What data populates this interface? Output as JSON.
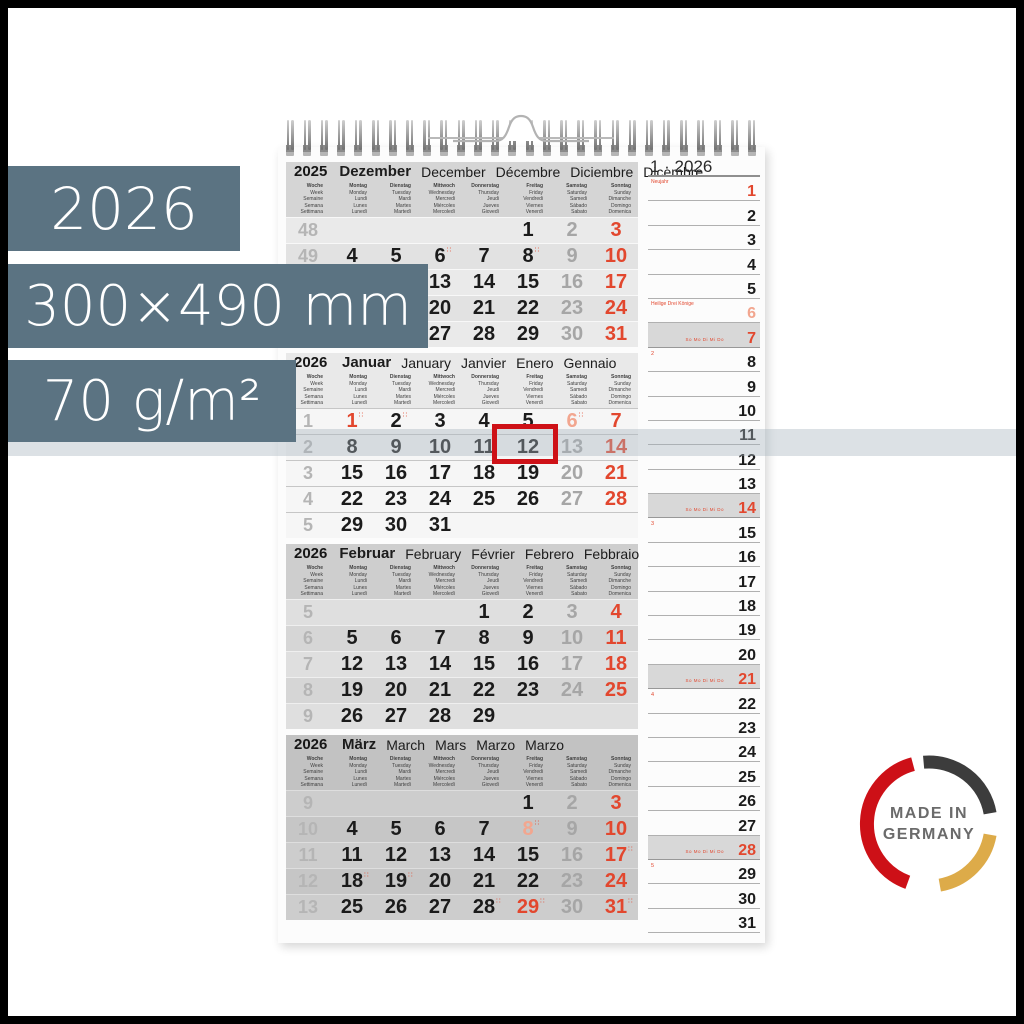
{
  "overlays": {
    "year": "2026",
    "size": "300×490 mm",
    "weight": "70 g/m²"
  },
  "colors": {
    "slate_overlay": "#5b7382",
    "accent_red": "#e2472e",
    "light_holiday": "#f2a68f",
    "saturday_gray": "#a6a6a6",
    "marker_red": "#ce1117",
    "badge_red": "#cd1017",
    "badge_dark": "#3c3c3c",
    "badge_gold": "#ddab49"
  },
  "badge": {
    "line1": "MADE IN",
    "line2": "GERMANY"
  },
  "marker": {
    "month": "Januar",
    "day": 12
  },
  "planner": {
    "header": "1 · 2026",
    "sunday_mini": "So Mo Di Mi Do",
    "days": [
      {
        "d": 1,
        "c": "r",
        "note": "Neujahr"
      },
      {
        "d": 2
      },
      {
        "d": 3
      },
      {
        "d": 4
      },
      {
        "d": 5
      },
      {
        "d": 6,
        "c": "s",
        "note": "Heilige Drei Könige"
      },
      {
        "d": 7,
        "c": "r",
        "sun": true
      },
      {
        "d": 8,
        "week": "2"
      },
      {
        "d": 9
      },
      {
        "d": 10
      },
      {
        "d": 11
      },
      {
        "d": 12
      },
      {
        "d": 13
      },
      {
        "d": 14,
        "c": "r",
        "sun": true
      },
      {
        "d": 15,
        "week": "3"
      },
      {
        "d": 16
      },
      {
        "d": 17
      },
      {
        "d": 18
      },
      {
        "d": 19
      },
      {
        "d": 20
      },
      {
        "d": 21,
        "c": "r",
        "sun": true
      },
      {
        "d": 22,
        "week": "4"
      },
      {
        "d": 23
      },
      {
        "d": 24
      },
      {
        "d": 25
      },
      {
        "d": 26
      },
      {
        "d": 27
      },
      {
        "d": 28,
        "c": "r",
        "sun": true
      },
      {
        "d": 29,
        "week": "5"
      },
      {
        "d": 30
      },
      {
        "d": 31
      }
    ]
  },
  "calendar": {
    "day_headers": [
      [
        "Woche",
        "Week",
        "Semaine",
        "Semana",
        "Settimana"
      ],
      [
        "Montag",
        "Monday",
        "Lundi",
        "Lunes",
        "Lunedì"
      ],
      [
        "Dienstag",
        "Tuesday",
        "Mardi",
        "Martes",
        "Martedì"
      ],
      [
        "Mittwoch",
        "Wednesday",
        "Mercredi",
        "Miércoles",
        "Mercoledì"
      ],
      [
        "Donnerstag",
        "Thursday",
        "Jeudi",
        "Jueves",
        "Giovedì"
      ],
      [
        "Freitag",
        "Friday",
        "Vendredi",
        "Viernes",
        "Venerdì"
      ],
      [
        "Samstag",
        "Saturday",
        "Samedi",
        "Sábado",
        "Sabato"
      ],
      [
        "Sonntag",
        "Sunday",
        "Dimanche",
        "Domingo",
        "Domenica"
      ]
    ],
    "months": [
      {
        "year": "2025",
        "theme": "dec",
        "names": [
          "Dezember",
          "December",
          "Décembre",
          "Diciembre",
          "Dicembre"
        ],
        "weeks": [
          {
            "w": "48",
            "days": [
              null,
              null,
              null,
              null,
              {
                "d": 1
              },
              {
                "d": 2,
                "c": "g"
              },
              {
                "d": 3,
                "c": "r"
              }
            ]
          },
          {
            "w": "49",
            "days": [
              {
                "d": 4
              },
              {
                "d": 5
              },
              {
                "d": 6,
                "m": true
              },
              {
                "d": 7
              },
              {
                "d": 8,
                "m": true
              },
              {
                "d": 9,
                "c": "g"
              },
              {
                "d": 10,
                "c": "r"
              }
            ]
          },
          {
            "w": "50",
            "days": [
              {
                "d": 11
              },
              {
                "d": 12
              },
              {
                "d": 13
              },
              {
                "d": 14
              },
              {
                "d": 15
              },
              {
                "d": 16,
                "c": "g"
              },
              {
                "d": 17,
                "c": "r"
              }
            ]
          },
          {
            "w": "51",
            "days": [
              {
                "d": 18
              },
              {
                "d": 19
              },
              {
                "d": 20
              },
              {
                "d": 21
              },
              {
                "d": 22
              },
              {
                "d": 23,
                "c": "g"
              },
              {
                "d": 24,
                "c": "r"
              }
            ]
          },
          {
            "w": "52",
            "days": [
              {
                "d": 25
              },
              {
                "d": 26
              },
              {
                "d": 27
              },
              {
                "d": 28
              },
              {
                "d": 29
              },
              {
                "d": 30,
                "c": "g"
              },
              {
                "d": 31,
                "c": "r"
              }
            ]
          }
        ]
      },
      {
        "year": "2026",
        "theme": "jan",
        "names": [
          "Januar",
          "January",
          "Janvier",
          "Enero",
          "Gennaio"
        ],
        "weeks": [
          {
            "w": "1",
            "days": [
              {
                "d": 1,
                "c": "r",
                "m": true
              },
              {
                "d": 2,
                "m": true
              },
              {
                "d": 3
              },
              {
                "d": 4
              },
              {
                "d": 5
              },
              {
                "d": 6,
                "c": "s",
                "m": true
              },
              {
                "d": 7,
                "c": "r"
              }
            ]
          },
          {
            "w": "2",
            "days": [
              {
                "d": 8
              },
              {
                "d": 9
              },
              {
                "d": 10
              },
              {
                "d": 11
              },
              {
                "d": 12
              },
              {
                "d": 13,
                "c": "g"
              },
              {
                "d": 14,
                "c": "r"
              }
            ]
          },
          {
            "w": "3",
            "days": [
              {
                "d": 15
              },
              {
                "d": 16
              },
              {
                "d": 17
              },
              {
                "d": 18
              },
              {
                "d": 19
              },
              {
                "d": 20,
                "c": "g"
              },
              {
                "d": 21,
                "c": "r"
              }
            ]
          },
          {
            "w": "4",
            "days": [
              {
                "d": 22
              },
              {
                "d": 23
              },
              {
                "d": 24
              },
              {
                "d": 25
              },
              {
                "d": 26
              },
              {
                "d": 27,
                "c": "g"
              },
              {
                "d": 28,
                "c": "r"
              }
            ]
          },
          {
            "w": "5",
            "days": [
              {
                "d": 29
              },
              {
                "d": 30
              },
              {
                "d": 31
              },
              null,
              null,
              null,
              null
            ]
          }
        ]
      },
      {
        "year": "2026",
        "theme": "feb",
        "names": [
          "Februar",
          "February",
          "Février",
          "Febrero",
          "Febbraio"
        ],
        "weeks": [
          {
            "w": "5",
            "days": [
              null,
              null,
              null,
              {
                "d": 1
              },
              {
                "d": 2
              },
              {
                "d": 3,
                "c": "g"
              },
              {
                "d": 4,
                "c": "r"
              }
            ]
          },
          {
            "w": "6",
            "days": [
              {
                "d": 5
              },
              {
                "d": 6
              },
              {
                "d": 7
              },
              {
                "d": 8
              },
              {
                "d": 9
              },
              {
                "d": 10,
                "c": "g"
              },
              {
                "d": 11,
                "c": "r"
              }
            ]
          },
          {
            "w": "7",
            "days": [
              {
                "d": 12
              },
              {
                "d": 13
              },
              {
                "d": 14
              },
              {
                "d": 15
              },
              {
                "d": 16
              },
              {
                "d": 17,
                "c": "g"
              },
              {
                "d": 18,
                "c": "r"
              }
            ]
          },
          {
            "w": "8",
            "days": [
              {
                "d": 19
              },
              {
                "d": 20
              },
              {
                "d": 21
              },
              {
                "d": 22
              },
              {
                "d": 23
              },
              {
                "d": 24,
                "c": "g"
              },
              {
                "d": 25,
                "c": "r"
              }
            ]
          },
          {
            "w": "9",
            "days": [
              {
                "d": 26
              },
              {
                "d": 27
              },
              {
                "d": 28
              },
              {
                "d": 29
              },
              null,
              null,
              null
            ]
          }
        ]
      },
      {
        "year": "2026",
        "theme": "mar",
        "names": [
          "März",
          "March",
          "Mars",
          "Marzo",
          "Marzo"
        ],
        "weeks": [
          {
            "w": "9",
            "days": [
              null,
              null,
              null,
              null,
              {
                "d": 1
              },
              {
                "d": 2,
                "c": "g"
              },
              {
                "d": 3,
                "c": "r"
              }
            ]
          },
          {
            "w": "10",
            "days": [
              {
                "d": 4
              },
              {
                "d": 5
              },
              {
                "d": 6
              },
              {
                "d": 7
              },
              {
                "d": 8,
                "c": "s",
                "m": true
              },
              {
                "d": 9,
                "c": "g"
              },
              {
                "d": 10,
                "c": "r"
              }
            ]
          },
          {
            "w": "11",
            "days": [
              {
                "d": 11
              },
              {
                "d": 12
              },
              {
                "d": 13
              },
              {
                "d": 14
              },
              {
                "d": 15
              },
              {
                "d": 16,
                "c": "g"
              },
              {
                "d": 17,
                "c": "r",
                "m": true
              }
            ]
          },
          {
            "w": "12",
            "days": [
              {
                "d": 18,
                "m": true
              },
              {
                "d": 19,
                "m": true
              },
              {
                "d": 20
              },
              {
                "d": 21
              },
              {
                "d": 22
              },
              {
                "d": 23,
                "c": "g"
              },
              {
                "d": 24,
                "c": "r"
              }
            ]
          },
          {
            "w": "13",
            "days": [
              {
                "d": 25
              },
              {
                "d": 26
              },
              {
                "d": 27
              },
              {
                "d": 28,
                "m": true
              },
              {
                "d": 29,
                "c": "r",
                "m": true
              },
              {
                "d": 30,
                "c": "g"
              },
              {
                "d": 31,
                "c": "r",
                "m": true
              }
            ]
          }
        ]
      }
    ]
  }
}
